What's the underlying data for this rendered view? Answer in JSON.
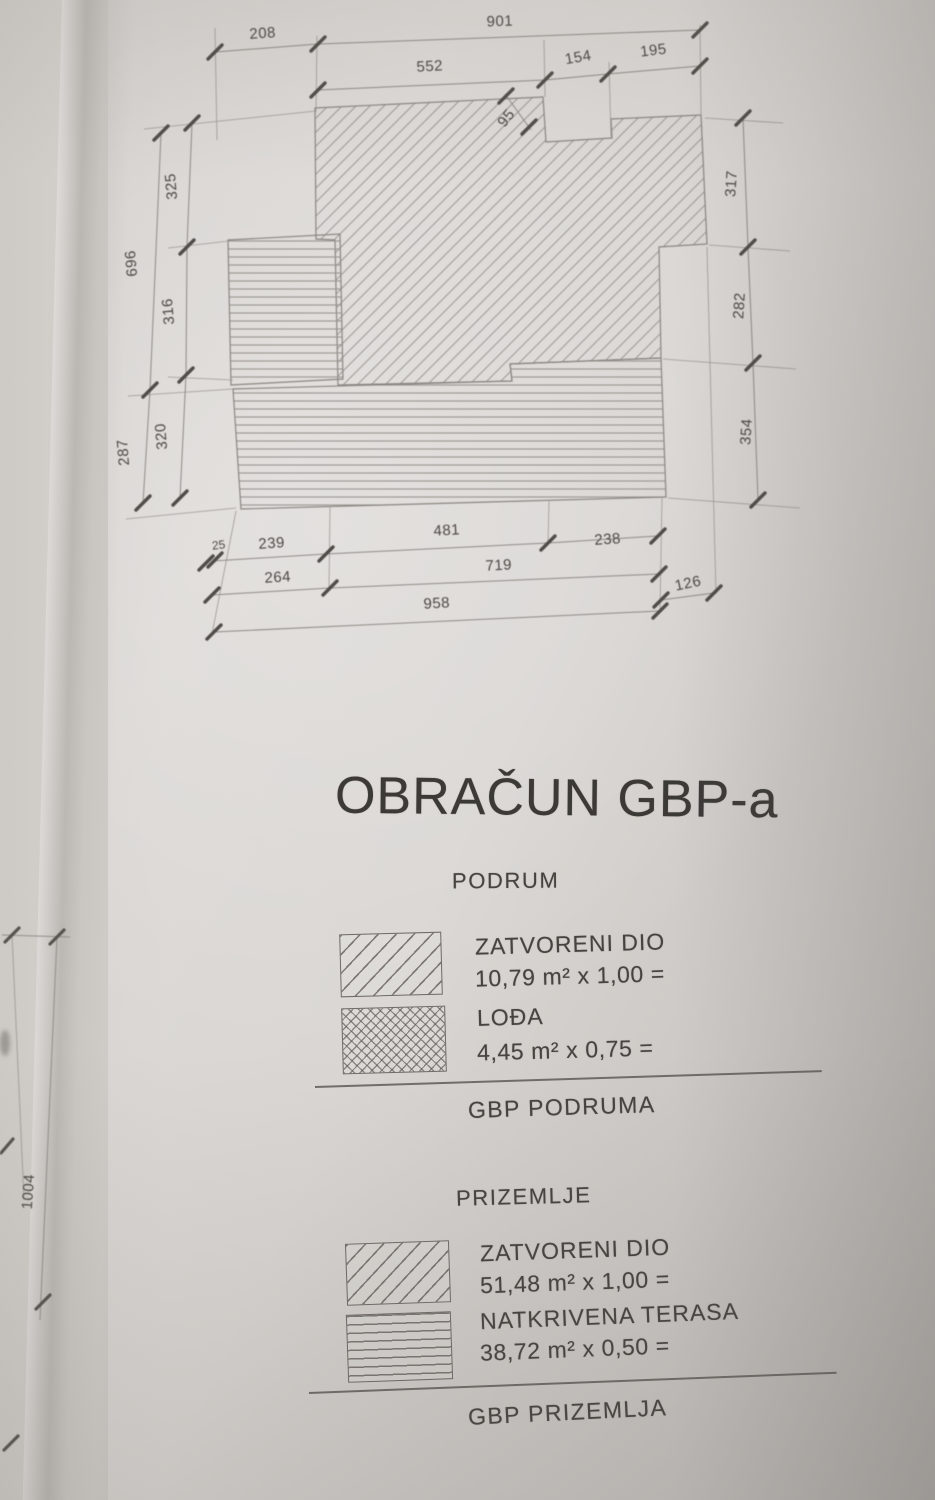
{
  "document": {
    "title": "OBRAČUN GBP-a",
    "sections": [
      {
        "name": "PODRUM",
        "items": [
          {
            "swatch": "diagonal-hatch",
            "label": "ZATVORENI DIO",
            "formula": "10,79 m² x 1,00 ="
          },
          {
            "swatch": "crosshatch",
            "label": "LOĐA",
            "formula": "4,45 m² x 0,75 ="
          }
        ],
        "total_label": "GBP PODRUMA"
      },
      {
        "name": "PRIZEMLJE",
        "items": [
          {
            "swatch": "diagonal-hatch",
            "label": "ZATVORENI DIO",
            "formula": "51,48 m² x 1,00 ="
          },
          {
            "swatch": "horizontal-lines",
            "label": "NATKRIVENA TERASA",
            "formula": "38,72 m² x 0,50 ="
          }
        ],
        "total_label": "GBP PRIZEMLJA"
      }
    ]
  },
  "plan": {
    "legend_meaning": {
      "diagonal-hatch": "zatvoreni dio",
      "horizontal-lines": "natkrivena terasa"
    },
    "dimensions": {
      "top_outer": [
        "208",
        "901"
      ],
      "top_inner": [
        "552",
        "154",
        "195"
      ],
      "diagonal": "95",
      "right_side": [
        "317",
        "282",
        "354"
      ],
      "left_outer": [
        "696",
        "287"
      ],
      "left_inner": [
        "325",
        "316",
        "320"
      ],
      "bottom_row1": [
        "25",
        "239",
        "481",
        "238"
      ],
      "bottom_row2": [
        "264",
        "719"
      ],
      "bottom_right_offset": "126",
      "bottom_total": "958"
    },
    "adjacent_page_dimension": "1004"
  },
  "colors": {
    "paper": "#d9d6d3",
    "ink": "#46423e",
    "drawing_line": "#8f8b87",
    "tick": "#504c48"
  }
}
